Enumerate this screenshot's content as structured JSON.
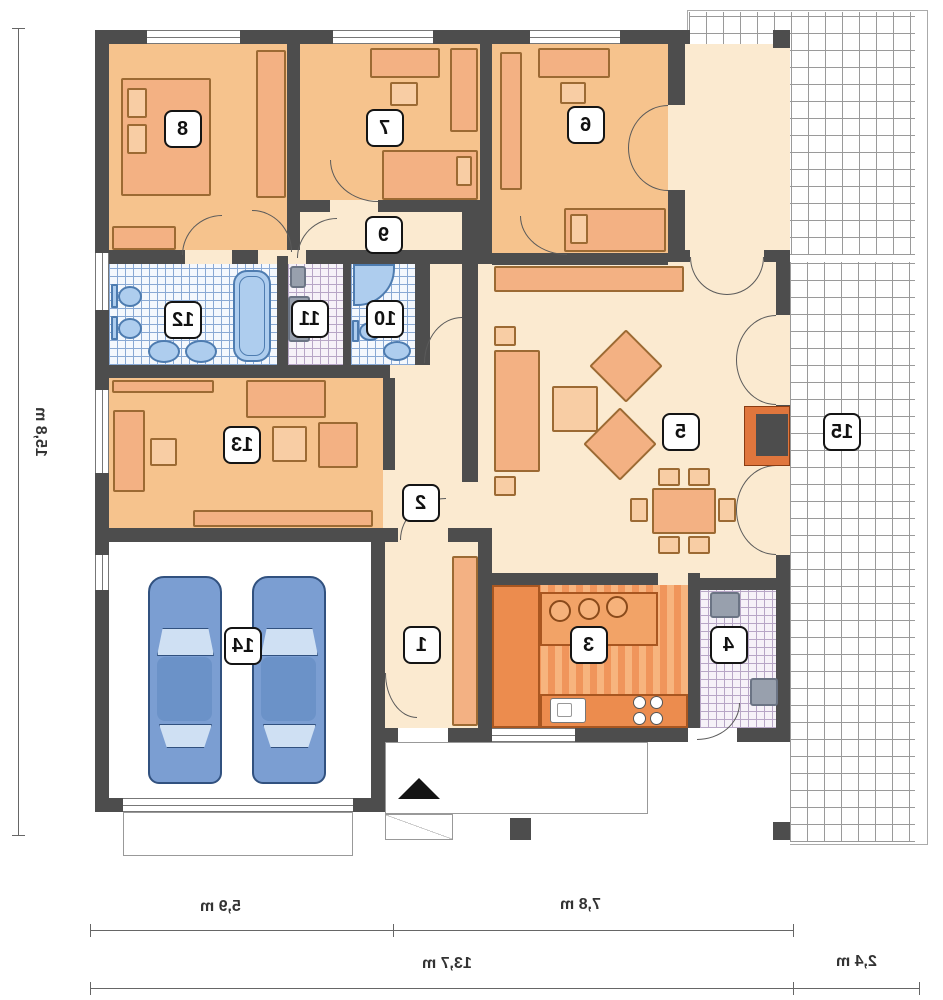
{
  "plan": {
    "rooms": [
      {
        "number": "1"
      },
      {
        "number": "2"
      },
      {
        "number": "3"
      },
      {
        "number": "4"
      },
      {
        "number": "5"
      },
      {
        "number": "6"
      },
      {
        "number": "7"
      },
      {
        "number": "8"
      },
      {
        "number": "9"
      },
      {
        "number": "10"
      },
      {
        "number": "11"
      },
      {
        "number": "12"
      },
      {
        "number": "13"
      },
      {
        "number": "14"
      },
      {
        "number": "15"
      }
    ],
    "dimensions": {
      "left_vertical": "15,8 m",
      "bottom_garage": "5,9 m",
      "bottom_living": "7,8 m",
      "bottom_total": "13,7 m",
      "bottom_terrace": "2,4 m"
    },
    "colors": {
      "wall": "#4d4d4d",
      "bedroom_floor": "#f6c38d",
      "hall_floor": "#fbead0",
      "kitchen_floor": "#f0955b",
      "furniture": "#f3b183",
      "sanitary_fixture": "#aecdee",
      "car": "#7b9ed2",
      "tile_blue_line": "#89a9d4",
      "tile_purple_line": "#b7a6c6",
      "terrace_grid_line": "#9a9a9a"
    }
  }
}
